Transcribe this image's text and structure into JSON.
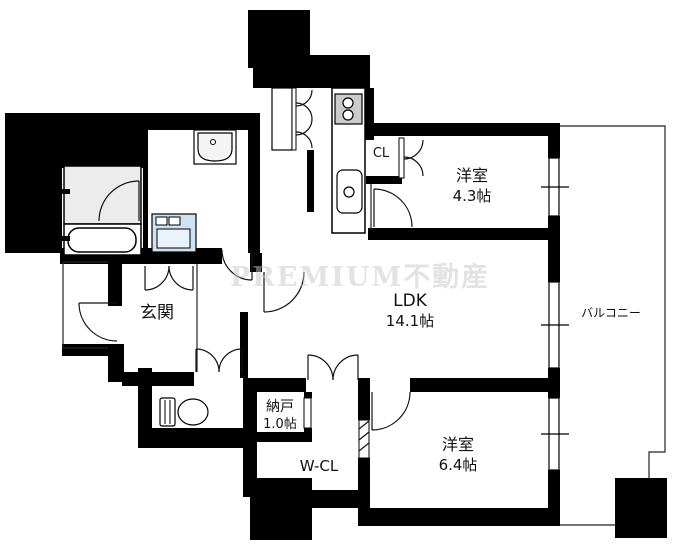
{
  "plan": {
    "type": "apartment-floor-plan",
    "watermark": "PREMIUM不動産",
    "rooms": {
      "entrance": {
        "label": "玄関"
      },
      "ldk": {
        "label": "LDK",
        "area": "14.1帖"
      },
      "bedroom1": {
        "label": "洋室",
        "area": "4.3帖"
      },
      "bedroom2": {
        "label": "洋室",
        "area": "6.4帖"
      },
      "storage_room": {
        "label": "納戸",
        "area": "1.0帖"
      },
      "walk_in_closet": {
        "label": "W-CL"
      },
      "closet": {
        "label": "CL"
      },
      "balcony": {
        "label": "バルコニー"
      }
    },
    "colors": {
      "wall": "#000000",
      "bathroom_floor": "#ececec",
      "washer_pan": "#cfe2f3",
      "washer_pan_inner": "#eaf3fb",
      "stove_panel": "#cccccc",
      "watermark_gray": "#c9c9c9"
    }
  }
}
